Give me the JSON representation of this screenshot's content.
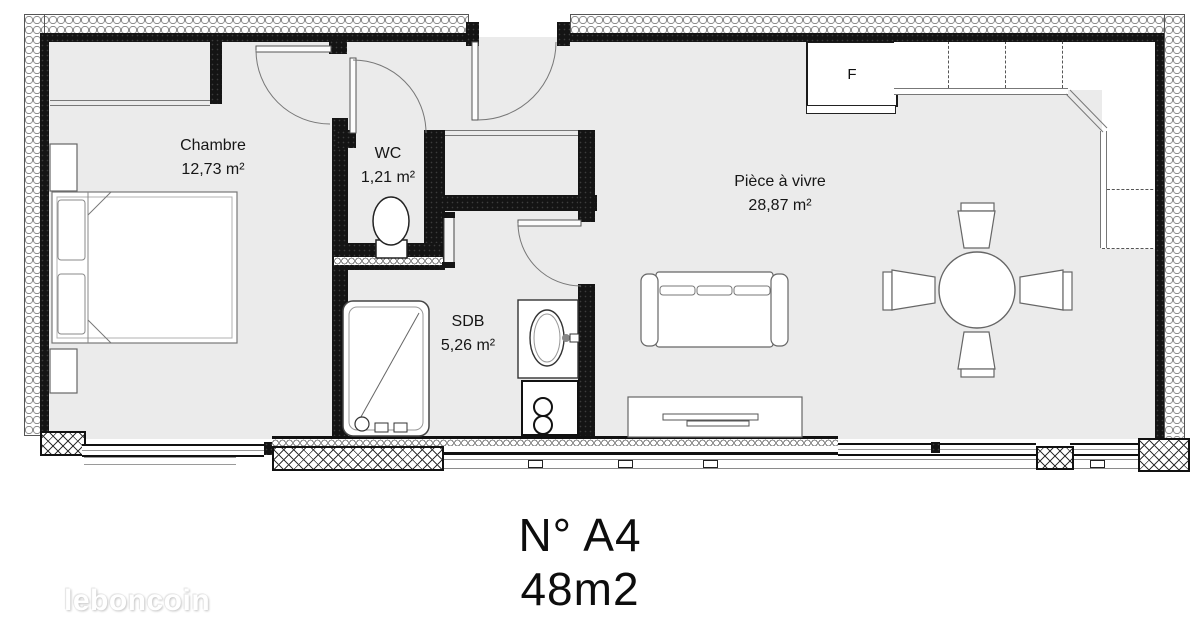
{
  "title": {
    "line1": "N° A4",
    "line2": "48m2"
  },
  "watermark": "leboncoin",
  "rooms": [
    {
      "name": "Chambre",
      "area": "12,73 m²"
    },
    {
      "name": "WC",
      "area": "1,21 m²"
    },
    {
      "name": "SDB",
      "area": "5,26 m²"
    },
    {
      "name": "Pièce à vivre",
      "area": "28,87 m²"
    }
  ],
  "appliances": {
    "fridge_label": "F"
  },
  "colors": {
    "wall": "#141414",
    "floor": "#ebebeb",
    "outline": "#666666",
    "text": "#111111"
  }
}
